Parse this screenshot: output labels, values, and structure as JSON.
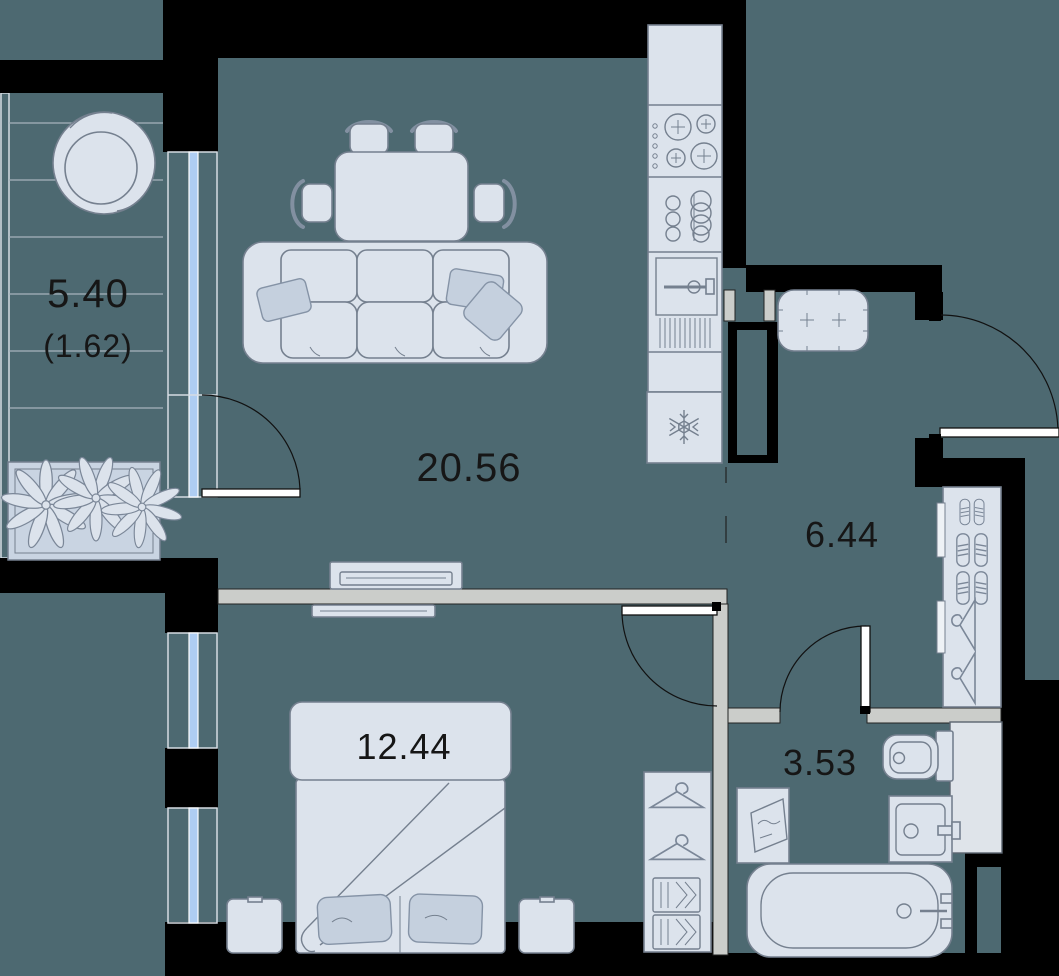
{
  "document": {
    "type": "apartment floor plan",
    "units": "square meters"
  },
  "rooms": {
    "living_kitchen": {
      "name": "living room with kitchen",
      "area": "20.56"
    },
    "hallway": {
      "name": "hallway",
      "area": "6.44"
    },
    "bedroom": {
      "name": "bedroom",
      "area": "12.44"
    },
    "bathroom": {
      "name": "bathroom",
      "area": "3.53"
    },
    "balcony": {
      "name": "balcony",
      "area": "5.40",
      "area_reduced": "(1.62)"
    }
  },
  "colors": {
    "background": "#4d6971",
    "wall": "#000000",
    "partition": "#cbcdca",
    "furniture_fill": "#dce3ec",
    "furniture_stroke": "#75808f",
    "accent_fill": "#c5d0de",
    "window_glass": "#aecdf2",
    "label_text": "#161616"
  },
  "icons": {
    "stove-icon": "4 burner circles with cross marks",
    "sink-icon": "stacked circles",
    "oven-icon": "door with handle and vents",
    "fridge-icon": "snowflake",
    "sofa-icon": "3-seat sofa with pillows",
    "dining-table-icon": "table with 4 chairs",
    "tv-icon": "flat screen",
    "bed-icon": "double bed with pillows and blanket",
    "wardrobe-icon": "hangers, shoes and boxes",
    "ottoman-icon": "tufted bench",
    "toilet-icon": "toilet top view",
    "washbasin-icon": "sink with faucet",
    "bathtub-icon": "tub with drain and faucet",
    "washer-icon": "open door with water wave",
    "plant-icon": "flower in planter box",
    "papasan-chair-icon": "round chair",
    "door-arc-icon": "door swing quarter-circle"
  }
}
